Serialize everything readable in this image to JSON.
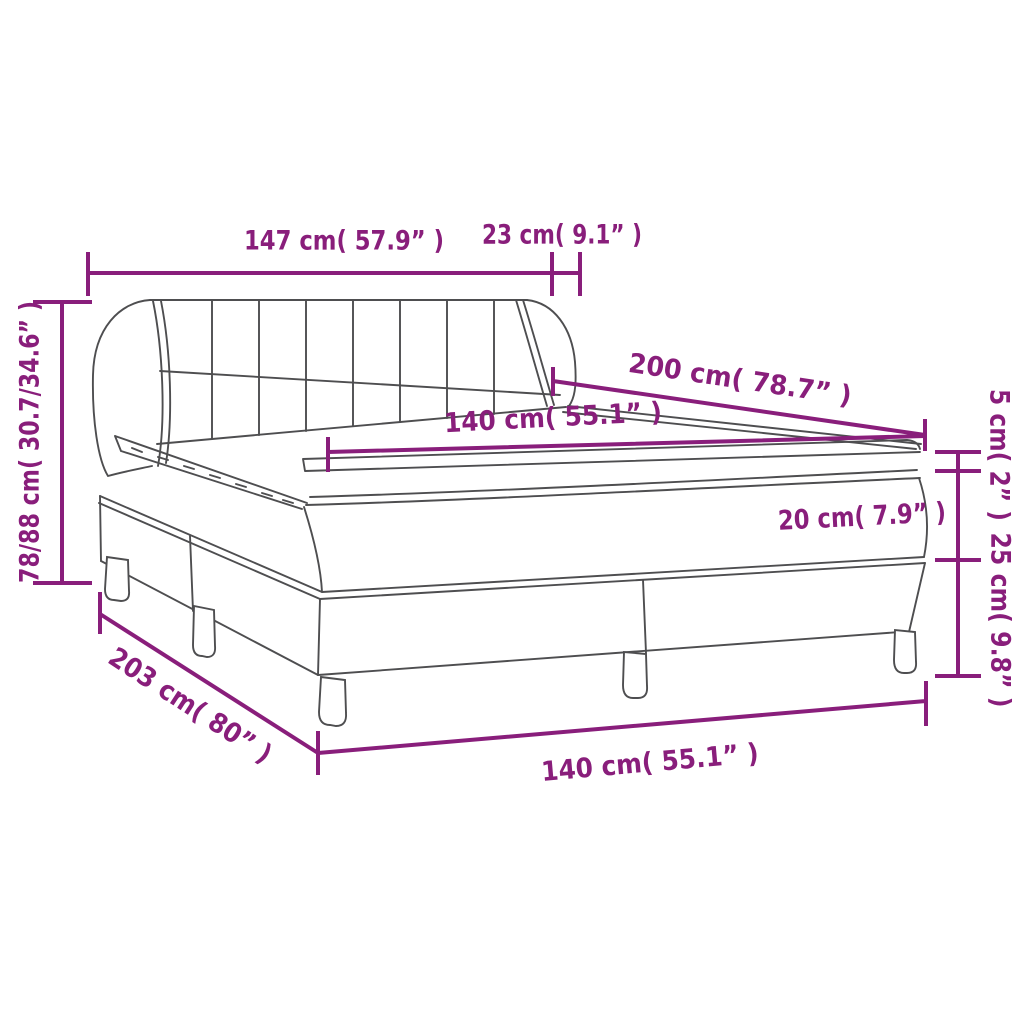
{
  "diagram": {
    "type": "product-dimension-diagram",
    "subject": "box spring bed with headboard, mattress, topper and legs",
    "colors": {
      "accent": "#891E7B",
      "line": "#4E4E50",
      "background": "#FFFFFF"
    },
    "labels": {
      "headboard_width": "147 cm( 57.9” )",
      "headboard_depth": "23 cm( 9.1” )",
      "bed_height_range": "78/88 cm( 30.7/34.6” )",
      "mattress_length": "200 cm( 78.7” )",
      "mattress_width": "140 cm( 55.1” )",
      "topper_height": "5 cm( 2” )",
      "mattress_height": "20 cm( 7.9” )",
      "base_leg_height": "25 cm( 9.8” )",
      "total_length": "203 cm( 80” )",
      "base_width": "140 cm( 55.1” )"
    }
  }
}
